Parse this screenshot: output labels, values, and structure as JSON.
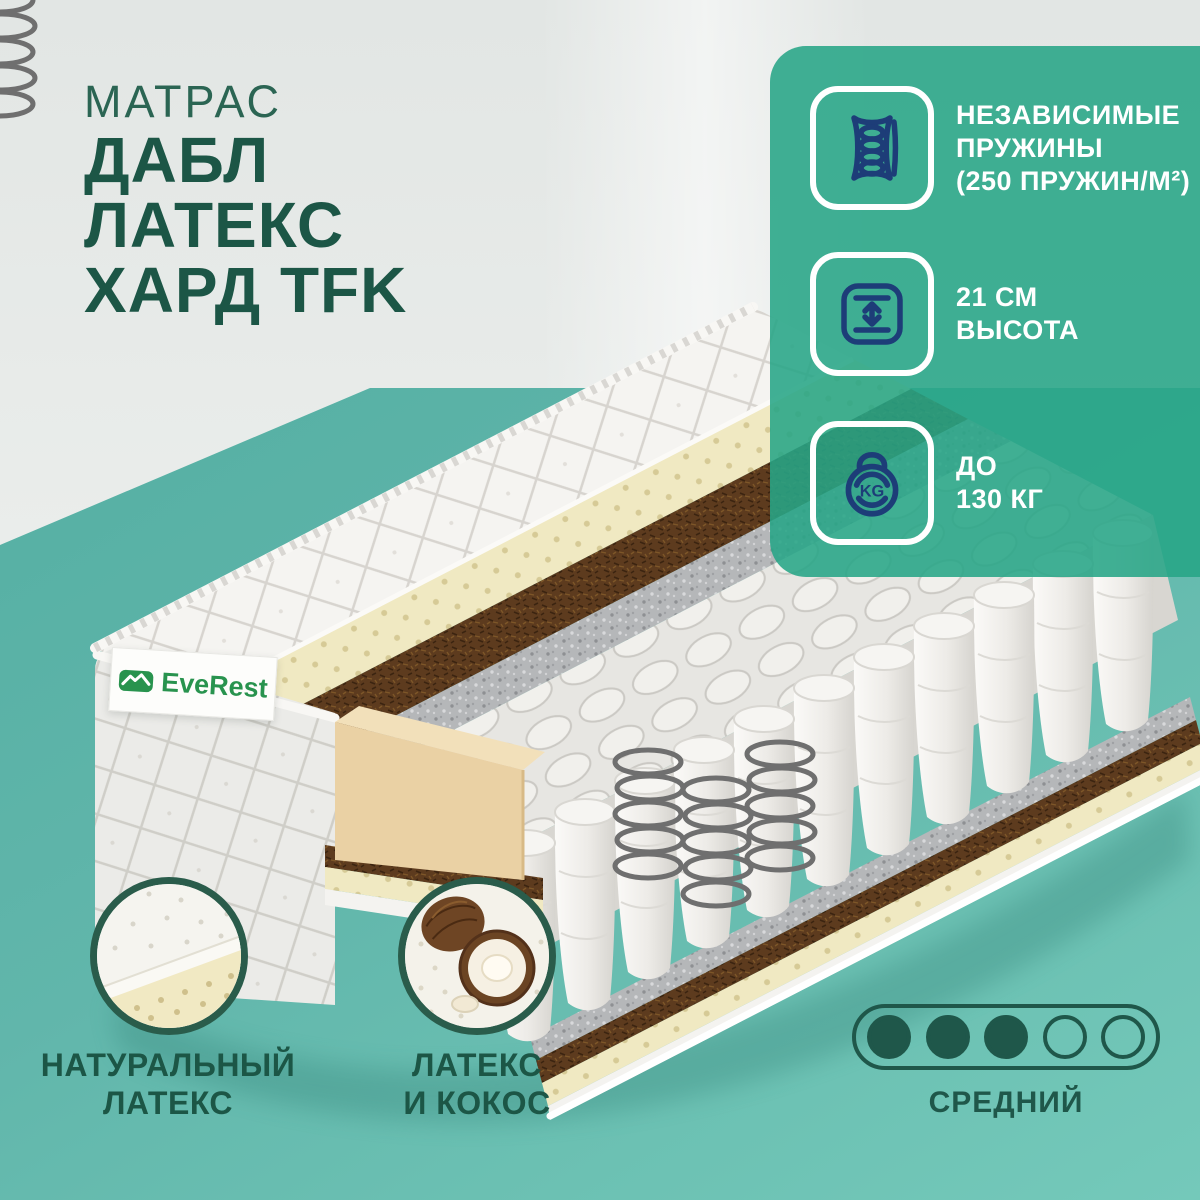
{
  "page": {
    "category_label": "МАТРАС",
    "title_lines": [
      "ДАБЛ",
      "ЛАТЕКС",
      "ХАРД TFK"
    ]
  },
  "brand": {
    "name": "EveRest"
  },
  "features": [
    {
      "icon": "independent-springs-icon",
      "lines": [
        "НЕЗАВИСИМЫЕ",
        "ПРУЖИНЫ",
        "(250 ПРУЖИН/М²)"
      ]
    },
    {
      "icon": "height-icon",
      "lines": [
        "21 СМ",
        "ВЫСОТА"
      ]
    },
    {
      "icon": "max-weight-icon",
      "icon_text": "KG",
      "lines": [
        "ДО",
        "130 КГ"
      ]
    }
  ],
  "callouts": [
    {
      "id": "natural-latex",
      "label_lines": [
        "НАТУРАЛЬНЫЙ",
        "ЛАТЕКС"
      ]
    },
    {
      "id": "latex-and-coconut",
      "label_lines": [
        "ЛАТЕКС",
        "И КОКОС"
      ]
    }
  ],
  "firmness": {
    "filled": 3,
    "total": 5,
    "label": "СРЕДНИЙ"
  },
  "colors": {
    "title_green": "#1c5646",
    "category_green": "#2b6553",
    "panel_teal": "#27a586",
    "floor_teal": "#5fb3ab",
    "icon_navy": "#1d3d78",
    "brand_green": "#28934e",
    "firmness_green": "#1f574a",
    "latex_cream": "#f0e9c2",
    "coir_brown": "#5d3b1e",
    "felt_gray": "#b5b7b9"
  }
}
